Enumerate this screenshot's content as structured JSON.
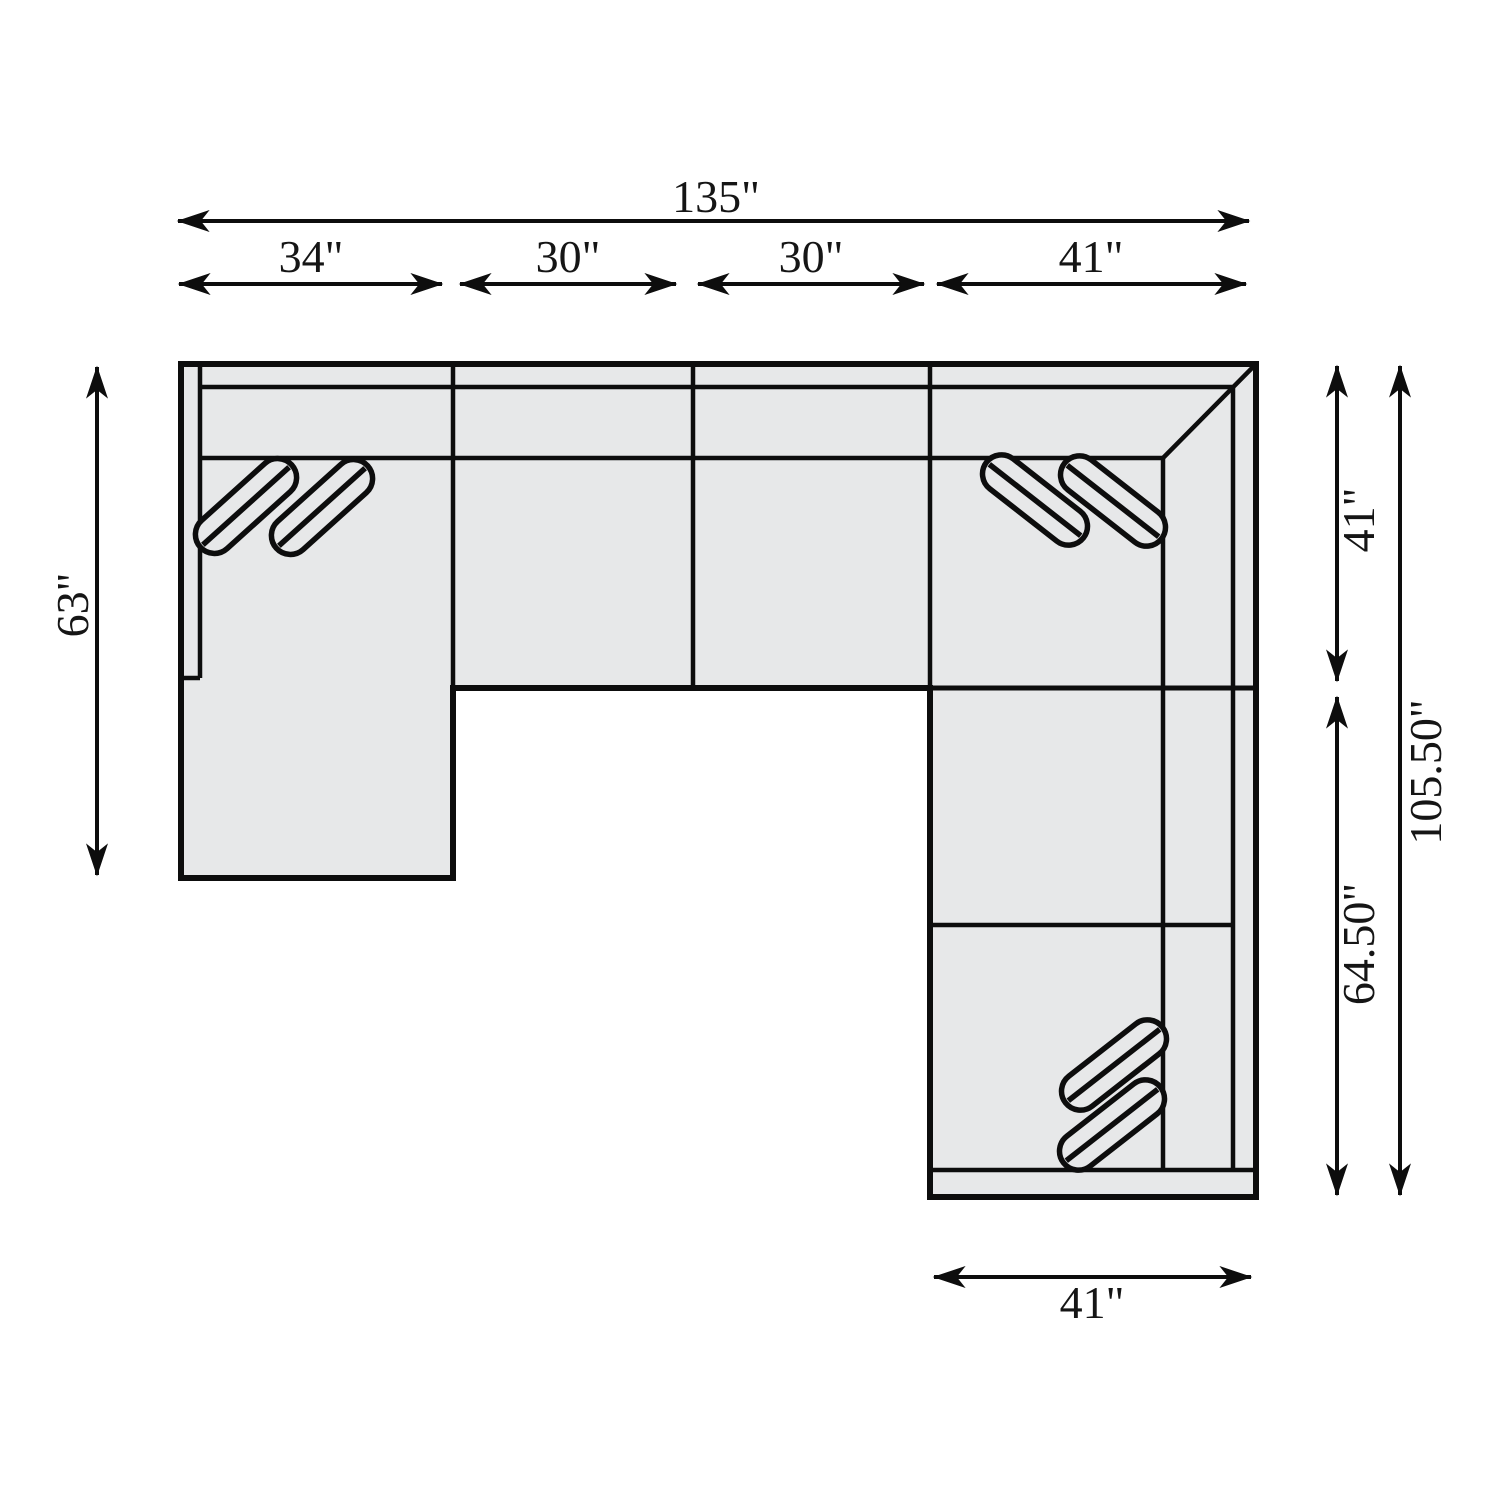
{
  "diagram": {
    "type": "sectional-sofa-floorplan-top-view",
    "background_color": "#ffffff",
    "sofa_fill_color": "#e7e8e9",
    "line_color": "#0d0d0d",
    "dimensions": {
      "top_total": "135\"",
      "top_segment_1": "34\"",
      "top_segment_2": "30\"",
      "top_segment_3": "30\"",
      "top_segment_4": "41\"",
      "left_height": "63\"",
      "right_upper": "41\"",
      "right_lower": "64.50\"",
      "right_total": "105.50\"",
      "bottom_width": "41\""
    },
    "parts": {
      "left_arm_chaise": "left chaise section with arm panel",
      "armless_chairs": "two 30\" armless middle sections",
      "corner_wedge": "41\" x 41\" mitered corner section",
      "right_return": "64.50\" right-arm section",
      "pillow_groups": 3
    }
  }
}
